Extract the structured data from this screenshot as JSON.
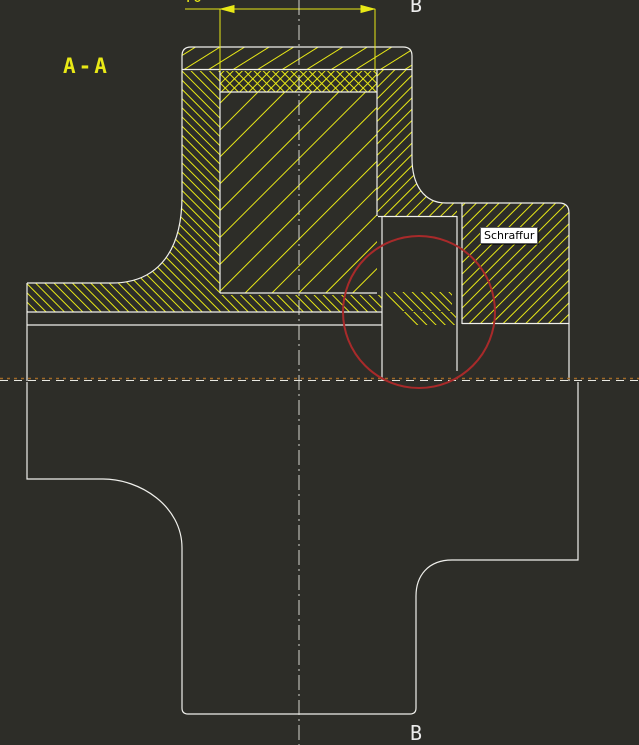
{
  "drawing": {
    "section_label": "A-A",
    "dimension_value": "40",
    "section_marker_top": "B",
    "section_marker_bottom": "B",
    "tooltip_text": "Schraffur"
  },
  "colors": {
    "background": "#2d2d28",
    "hatch": "#e8e816",
    "outline": "#f0f0ec",
    "highlight_circle": "#a82a2a",
    "section_line": "#a06a28",
    "centerline": "#e8e8e0",
    "tooltip_bg": "#ffffff",
    "tooltip_text": "#000000"
  }
}
